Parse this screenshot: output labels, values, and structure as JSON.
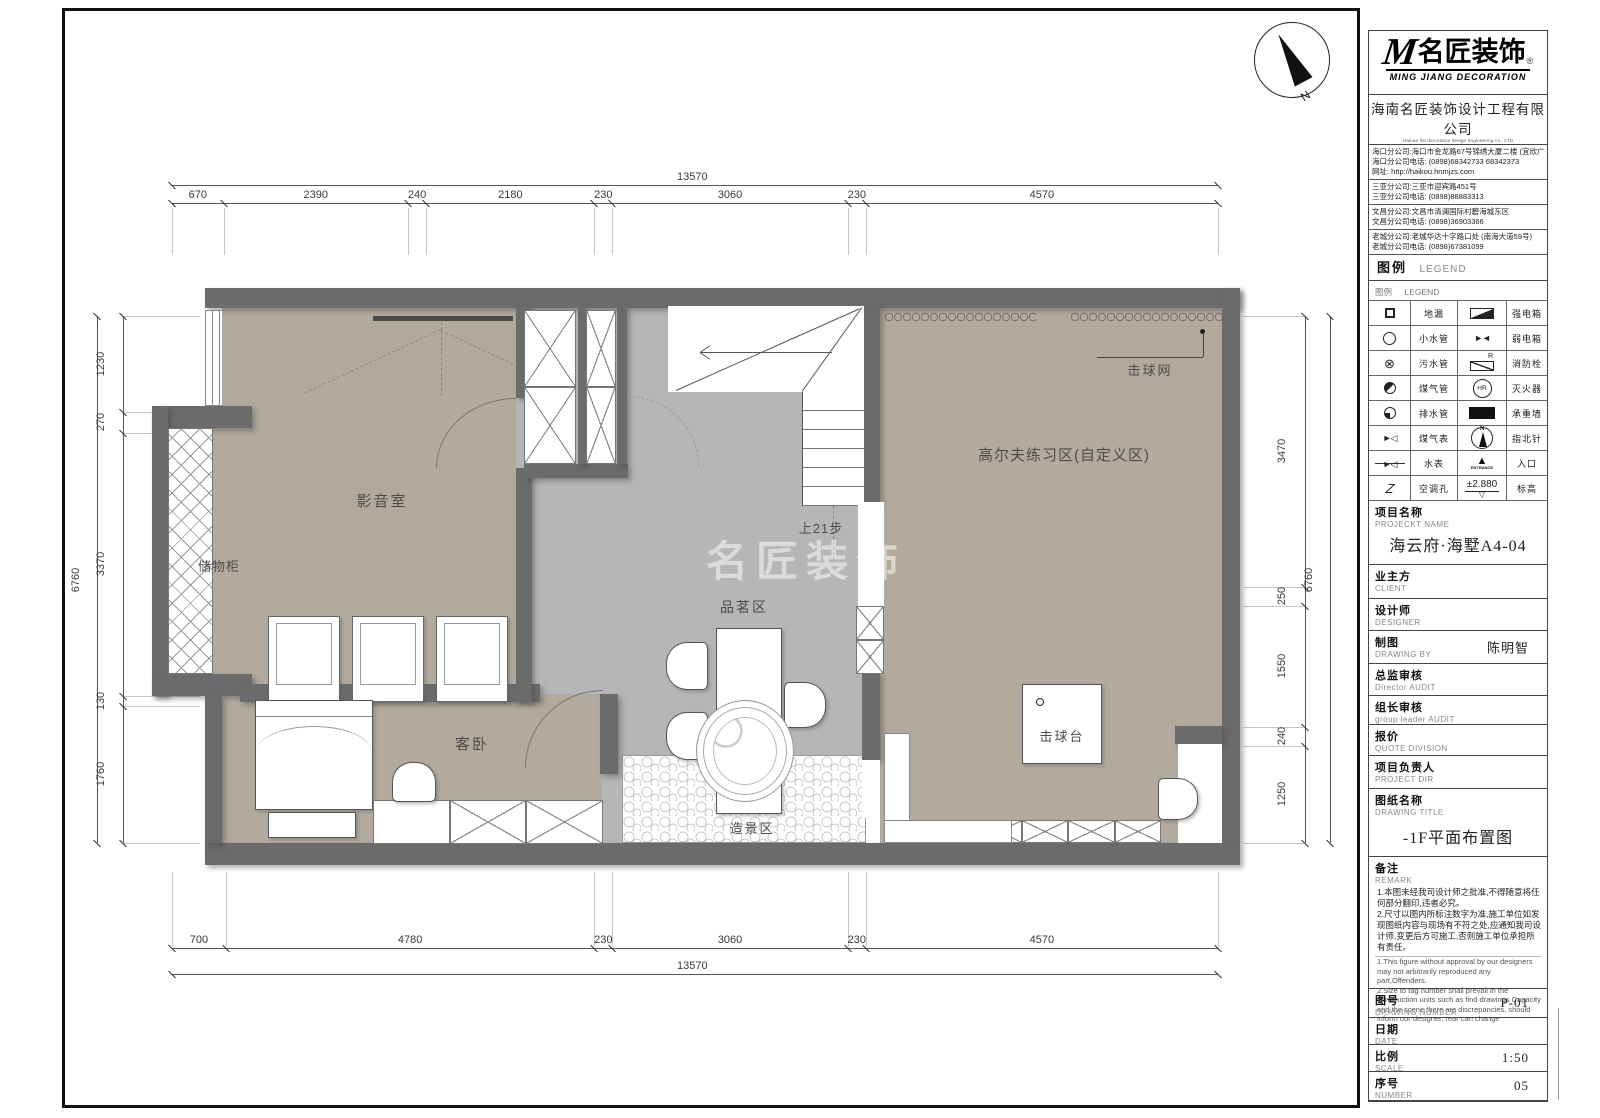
{
  "colors": {
    "wall": "#6b6b6b",
    "floor_warm": "#b3aa9e",
    "floor_cool": "#b6b6b8",
    "frame": "#111111"
  },
  "plan": {
    "watermark": "名匠装饰",
    "compass_n": "N",
    "labels": {
      "av_room": "影音室",
      "storage": "储物柜",
      "guest_bedroom": "客卧",
      "tea_area": "品茗区",
      "landscape_area": "造景区",
      "golf_area": "高尔夫练习区(自定义区)",
      "hitting_net": "击球网",
      "hitting_tee": "击球台",
      "stairs_note": "上21步"
    },
    "dimensions": {
      "top": {
        "total": 13570,
        "segments": [
          670,
          2390,
          240,
          2180,
          230,
          3060,
          230,
          4570
        ]
      },
      "bottom": {
        "total": 13570,
        "segments": [
          700,
          4780,
          230,
          3060,
          230,
          4570
        ]
      },
      "left": {
        "total": 6760,
        "segments": [
          1230,
          270,
          3370,
          130,
          1760
        ]
      },
      "right": {
        "total": 6760,
        "segments": [
          3470,
          250,
          1550,
          240,
          1250
        ]
      }
    }
  },
  "title_block": {
    "logo": {
      "brand_m": "M",
      "brand": "名匠装饰",
      "reg": "®",
      "sub": "MING JIANG DECORATION"
    },
    "company": {
      "name": "海南名匠装饰设计工程有限公司",
      "name_en": "Hainan list decoration design engineering co., LTD",
      "slogan": "精 雕 细 琢 ● 名 匠 本 色"
    },
    "branches": [
      {
        "lines": [
          "海口分公司:海口市金龙路67号锦绣大厦二楼 (宜欣广场对面)",
          "海口分公司电话: (0898)68342733 68342373",
          "网址: http://haikou.hnmjzs.com"
        ]
      },
      {
        "lines": [
          "三亚分公司:三亚市迎宾路451号",
          "三亚分公司电话: (0898)88883313"
        ]
      },
      {
        "lines": [
          "文昌分公司:文昌市清澜国际村碧海城东区",
          "文昌分公司电话: (0898)36903366"
        ]
      },
      {
        "lines": [
          "老城分公司:老城华达十字路口处 (南海大道59号)",
          "老城分公司电话: (0898)67381099"
        ]
      }
    ],
    "legend": {
      "header_cn": "图例",
      "header_en": "LEGEND",
      "subheader_cn": "图例",
      "subheader_en": "LEGEND",
      "hydrant_letter": "R",
      "extinguisher_label": "HR",
      "entrance_label": "ENTRANCE",
      "elevation_value": "±2.880",
      "north_letter": "N",
      "ac_letter": "Z",
      "rows": [
        {
          "l_icon": "floor-drain-icon",
          "l": "地漏",
          "r_icon": "strong-power-box-icon",
          "r": "强电箱"
        },
        {
          "l_icon": "small-water-pipe-icon",
          "l": "小水管",
          "r_icon": "weak-power-box-icon",
          "r": "弱电箱"
        },
        {
          "l_icon": "sewage-pipe-icon",
          "l": "污水管",
          "r_icon": "fire-hydrant-icon",
          "r": "消防栓"
        },
        {
          "l_icon": "gas-pipe-icon",
          "l": "煤气管",
          "r_icon": "fire-extinguisher-icon",
          "r": "灭火器"
        },
        {
          "l_icon": "drain-pipe-icon",
          "l": "排水管",
          "r_icon": "load-bearing-wall-icon",
          "r": "承重墙"
        },
        {
          "l_icon": "gas-meter-icon",
          "l": "煤气表",
          "r_icon": "north-compass-icon",
          "r": "指北针"
        },
        {
          "l_icon": "water-meter-icon",
          "l": "水表",
          "r_icon": "entrance-icon",
          "r": "入口"
        },
        {
          "l_icon": "ac-hole-icon",
          "l": "空调孔",
          "r_icon": "elevation-icon",
          "r": "标高"
        }
      ]
    },
    "fields": [
      {
        "cn": "项目名称",
        "en": "PROJECKT NAME",
        "value": "海云府·海墅A4-04"
      },
      {
        "cn": "业主方",
        "en": "CLIENT",
        "value": ""
      },
      {
        "cn": "设计师",
        "en": "DESIGNER",
        "value": ""
      },
      {
        "cn": "制图",
        "en": "DRAWING BY",
        "value": "陈明智"
      },
      {
        "cn": "总监审核",
        "en": "Director AUDIT",
        "value": ""
      },
      {
        "cn": "组长审核",
        "en": "group leader AUDIT",
        "value": ""
      },
      {
        "cn": "报价",
        "en": "QUOTE DIVISION",
        "value": ""
      },
      {
        "cn": "项目负责人",
        "en": "PROJECT DIR",
        "value": ""
      },
      {
        "cn": "图纸名称",
        "en": "DRAWING TITLE",
        "value": "-1F平面布置图"
      },
      {
        "cn": "备注",
        "en": "REMARK",
        "value": "",
        "notes_cn": [
          "1.本图未经我司设计师之批准,不得随意将任何部分翻印,违者必究。",
          "2.尺寸以图内所标注数字为准,施工单位如发现图纸内容与现场有不符之处,应通知我司设计师,变更后方可施工,否则施工单位承担所有责任。"
        ],
        "notes_en": [
          "1.This figure without approval by our designers may not arbitrarily reproduced any part,Offenders.",
          "2.Size to tag number shall prevail in the construction units such as find drawings Capacity and the scene there are discrepancies, should inform our designer, rear can change"
        ]
      },
      {
        "cn": "图号",
        "en": "DRAWING NUMBER",
        "value": "P-01"
      },
      {
        "cn": "日期",
        "en": "DATE",
        "value": ""
      },
      {
        "cn": "比例",
        "en": "SCALE",
        "value": "1:50"
      },
      {
        "cn": "序号",
        "en": "NUMBER",
        "value": "05"
      }
    ]
  }
}
